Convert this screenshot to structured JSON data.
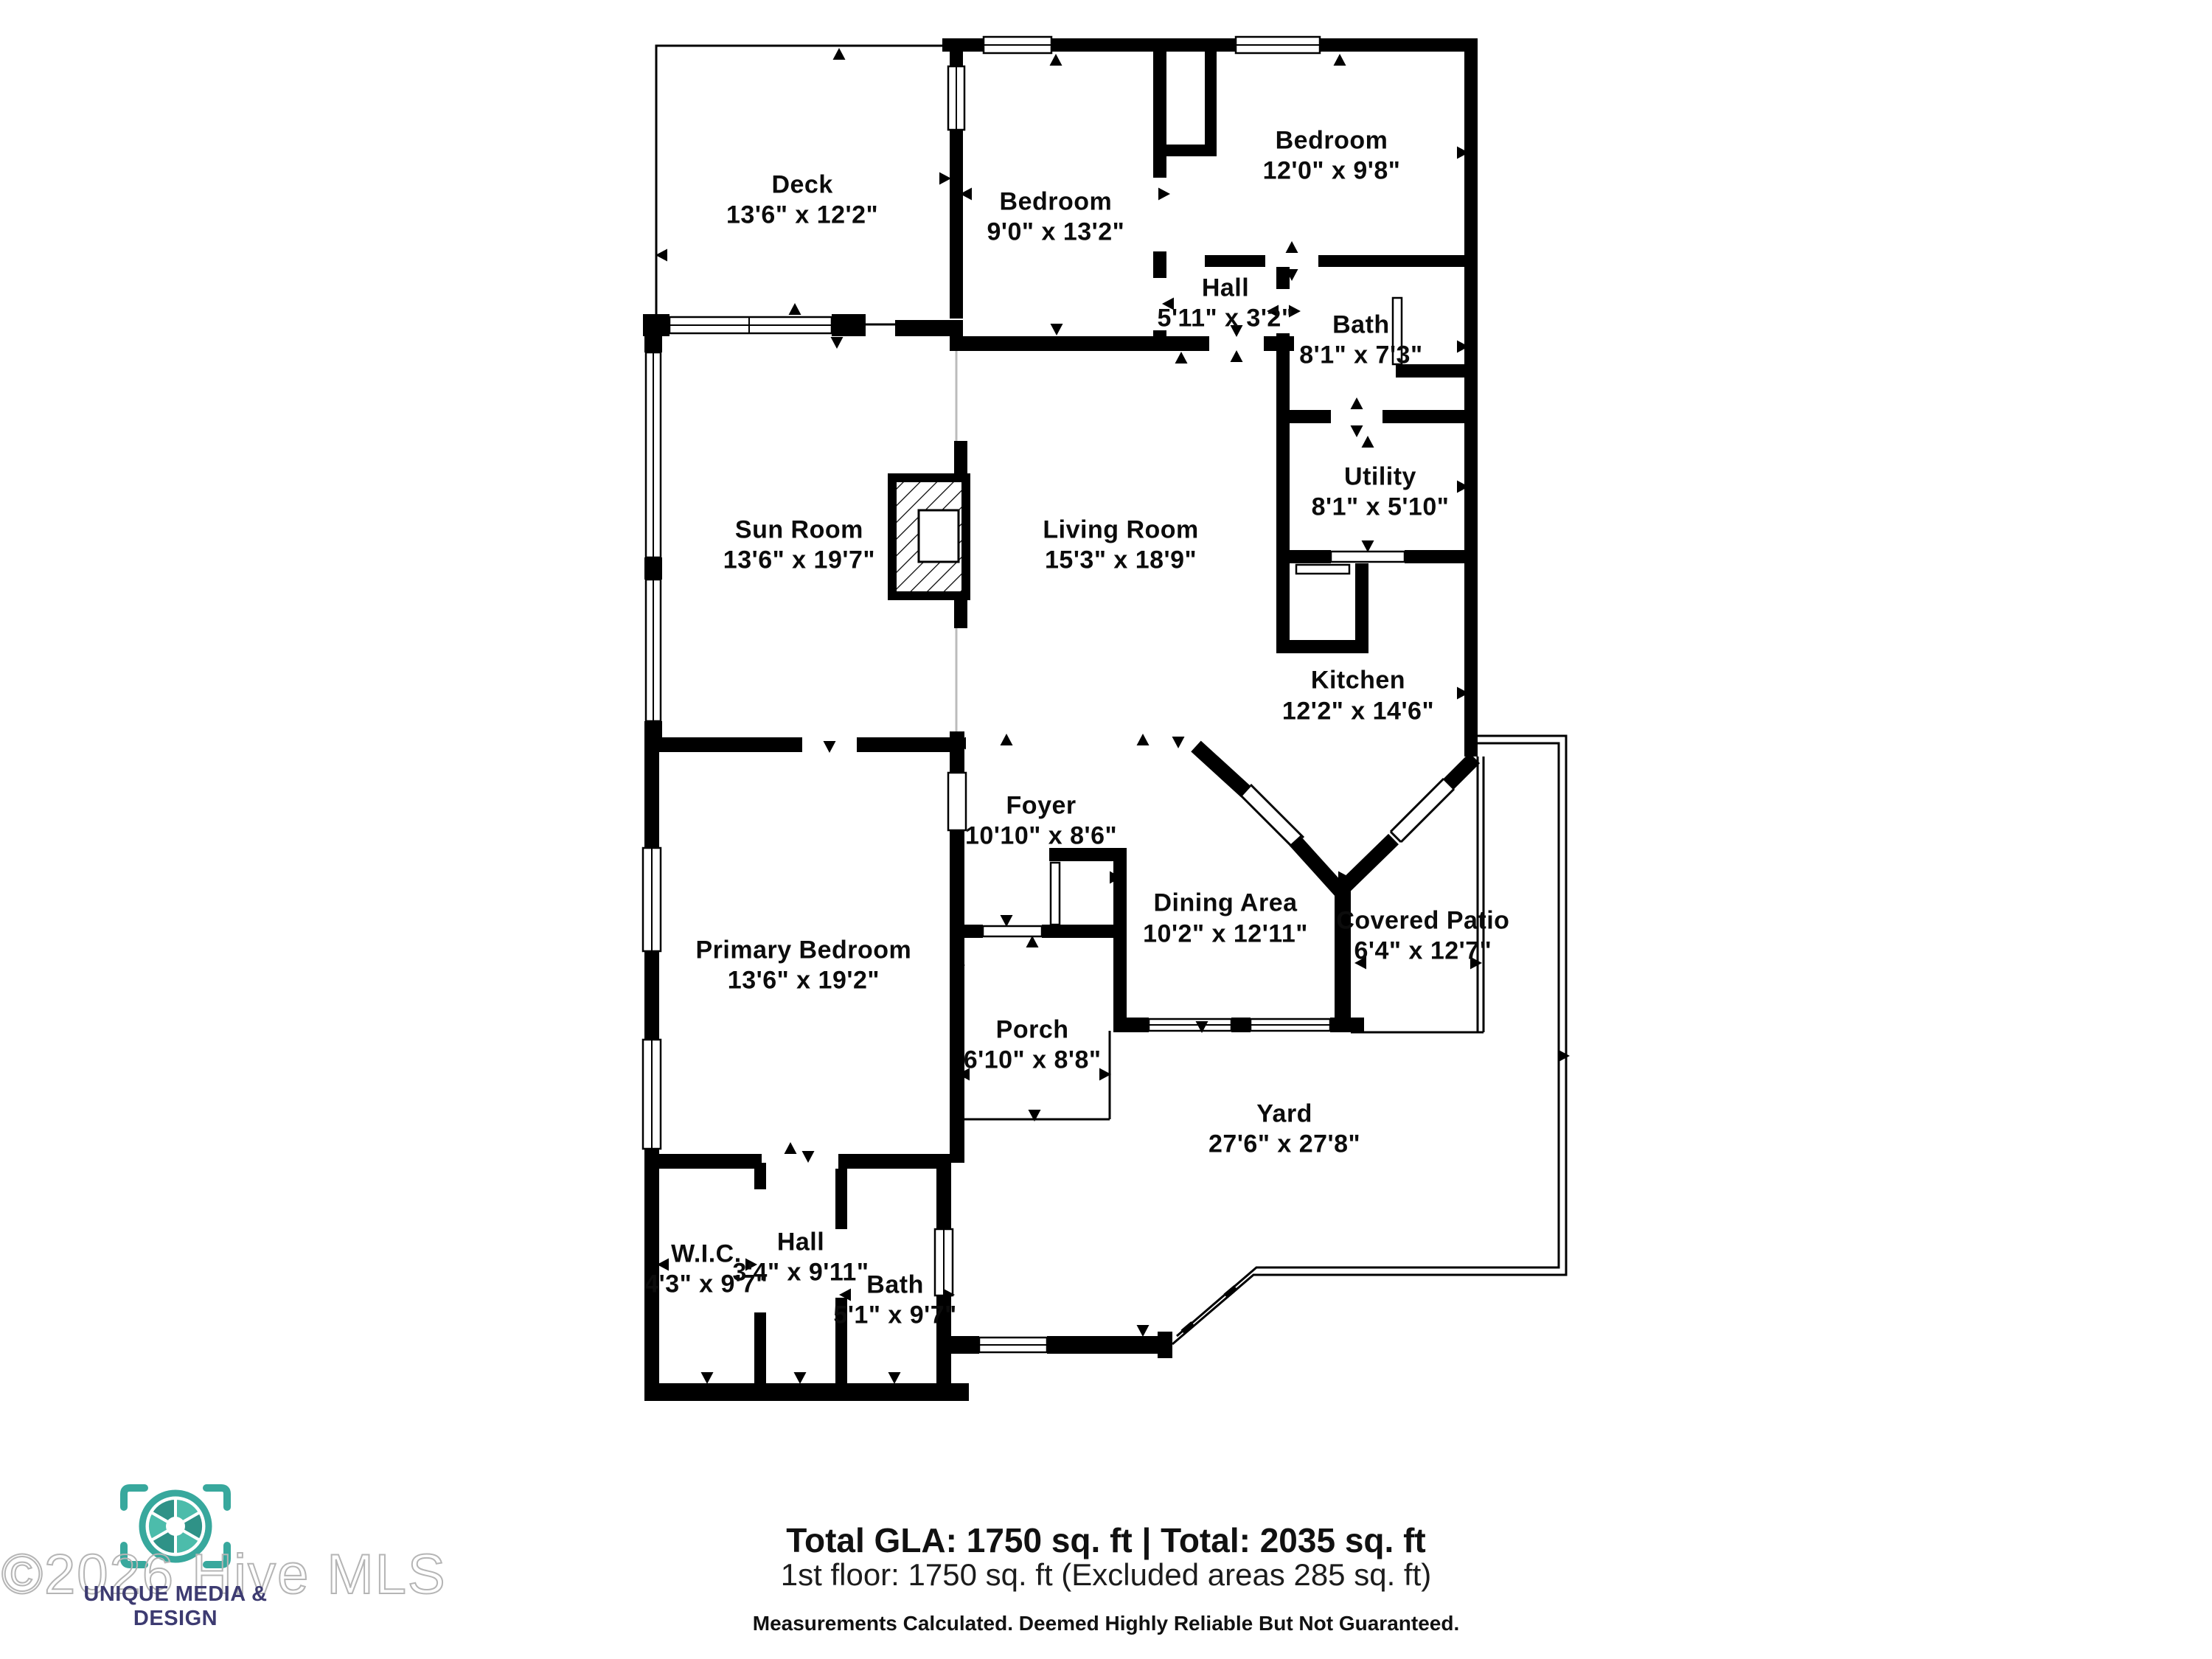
{
  "plan": {
    "rooms": [
      {
        "id": "deck",
        "name": "Deck",
        "dims": "13'6\" x 12'2\""
      },
      {
        "id": "bedroom-1",
        "name": "Bedroom",
        "dims": "9'0\" x 13'2\""
      },
      {
        "id": "bedroom-2",
        "name": "Bedroom",
        "dims": "12'0\" x 9'8\""
      },
      {
        "id": "hall-upper",
        "name": "Hall",
        "dims": "5'11\" x 3'2\""
      },
      {
        "id": "bath-upper",
        "name": "Bath",
        "dims": "8'1\" x 7'3\""
      },
      {
        "id": "sun-room",
        "name": "Sun Room",
        "dims": "13'6\" x 19'7\""
      },
      {
        "id": "living-room",
        "name": "Living Room",
        "dims": "15'3\" x 18'9\""
      },
      {
        "id": "utility",
        "name": "Utility",
        "dims": "8'1\" x 5'10\""
      },
      {
        "id": "kitchen",
        "name": "Kitchen",
        "dims": "12'2\" x 14'6\""
      },
      {
        "id": "foyer",
        "name": "Foyer",
        "dims": "10'10\" x 8'6\""
      },
      {
        "id": "dining-area",
        "name": "Dining Area",
        "dims": "10'2\" x 12'11\""
      },
      {
        "id": "covered-patio",
        "name": "Covered Patio",
        "dims": "6'4\" x 12'7\""
      },
      {
        "id": "primary-bedroom",
        "name": "Primary Bedroom",
        "dims": "13'6\" x 19'2\""
      },
      {
        "id": "porch",
        "name": "Porch",
        "dims": "6'10\" x 8'8\""
      },
      {
        "id": "yard",
        "name": "Yard",
        "dims": "27'6\" x 27'8\""
      },
      {
        "id": "wic",
        "name": "W.I.C.",
        "dims": "4'3\" x 9'7\""
      },
      {
        "id": "hall-lower",
        "name": "Hall",
        "dims": "3'4\" x 9'11\""
      },
      {
        "id": "bath-lower",
        "name": "Bath",
        "dims": "5'1\" x 9'7\""
      }
    ]
  },
  "footer": {
    "line1": "Total GLA: 1750 sq. ft | Total: 2035 sq. ft",
    "line2": "1st floor: 1750 sq. ft (Excluded areas 285 sq. ft)",
    "disclaimer": "Measurements Calculated. Deemed Highly Reliable But Not Guaranteed."
  },
  "branding": {
    "watermark": "©2026 Hive MLS",
    "company": "UNIQUE MEDIA & DESIGN",
    "colors": {
      "teal": "#38a89d",
      "teal_light": "#4cbcab",
      "teal_dark": "#2f9287",
      "navy": "#3d3b71",
      "wall": "#000000",
      "watermark_gray": "#b5b5b5"
    }
  }
}
